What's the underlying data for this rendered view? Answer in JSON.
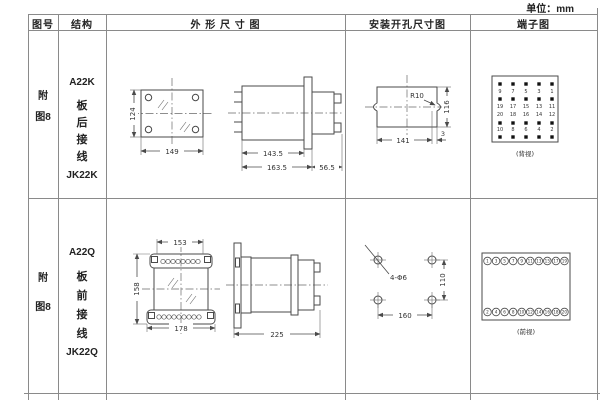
{
  "unit_label": "单位：mm",
  "colors": {
    "table_line": "#8a8a8a",
    "drawing_line": "#4a4a4a",
    "text": "#2b2b2b"
  },
  "header": {
    "figure": "图号",
    "structure": "结构",
    "outline": "外 形 尺 寸 图",
    "mounting": "安装开孔尺寸图",
    "terminal": "端子图"
  },
  "rows": [
    {
      "figure_no": "附图8",
      "structure": {
        "model": "A22K",
        "wiring": "板后接线",
        "code": "JK22K"
      },
      "outline": {
        "front_height": "124",
        "front_width": "149",
        "body_length": "143.5",
        "total_length": "163.5",
        "rear_length": "56.5"
      },
      "mounting": {
        "radius": "R10",
        "cutout_width": "141",
        "cutout_height": "116",
        "edge_offset": "3"
      },
      "terminal": {
        "view": "(背视)",
        "rows": [
          [
            "9",
            "7",
            "5",
            "3",
            "1"
          ],
          [
            "19",
            "17",
            "15",
            "13",
            "11"
          ],
          [
            "20",
            "18",
            "16",
            "14",
            "12"
          ],
          [
            "10",
            "8",
            "6",
            "4",
            "2"
          ]
        ]
      }
    },
    {
      "figure_no": "附图8",
      "structure": {
        "model": "A22Q",
        "wiring": "板前接线",
        "code": "JK22Q"
      },
      "outline": {
        "top_width": "153",
        "front_height": "158",
        "bottom_width": "178",
        "side_length": "225"
      },
      "mounting": {
        "holes": "4-Φ6",
        "hole_spacing_x": "160",
        "hole_spacing_y": "110"
      },
      "terminal": {
        "view": "(前视)",
        "top_row": [
          "1",
          "3",
          "5",
          "7",
          "9",
          "11",
          "13",
          "15",
          "17",
          "19"
        ],
        "bottom_row": [
          "2",
          "4",
          "6",
          "8",
          "10",
          "12",
          "14",
          "16",
          "18",
          "20"
        ]
      }
    }
  ]
}
